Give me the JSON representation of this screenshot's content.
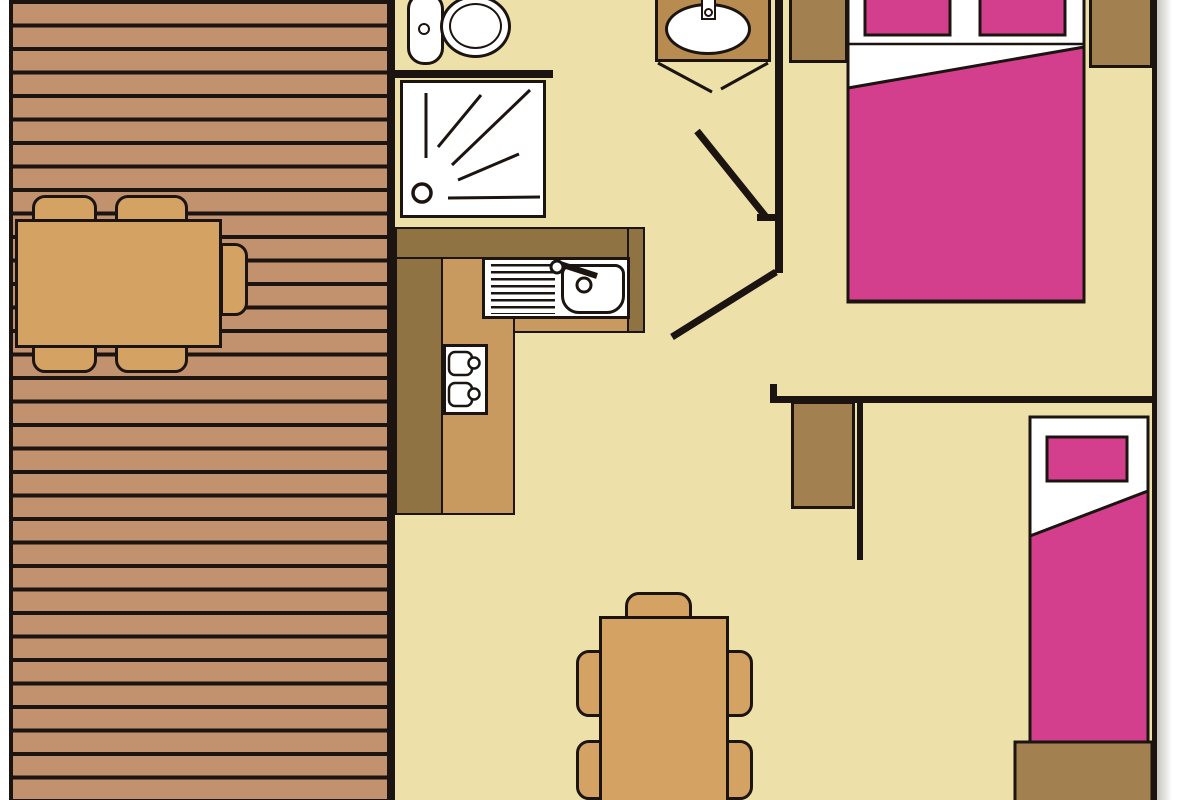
{
  "title": "chalet-floor-plan",
  "colors": {
    "outside": "#ffffff",
    "floor": "#ede0a8",
    "line": "#1b1410",
    "deck_plank": "#c2916e",
    "wood_furniture": "#d4a263",
    "kitchen_dark": "#8f7342",
    "kitchen_light": "#c89a5f",
    "cabinet_brown": "#a2804f",
    "vanity_brown": "#b88b50",
    "textile_pink": "#d43f8d",
    "fixture_white": "#ffffff",
    "shadow": "rgba(90,85,70,0.35)"
  },
  "rooms": [
    {
      "name": "terrace-deck",
      "furniture": [
        "outdoor-table",
        "outdoor-chair x5",
        "plank-decking"
      ]
    },
    {
      "name": "bathroom",
      "furniture": [
        "toilet",
        "shower-tray",
        "washbasin-vanity",
        "door-swing"
      ]
    },
    {
      "name": "kitchen",
      "furniture": [
        "l-shaped-counter",
        "sink-with-drainboard",
        "two-burner-hob"
      ]
    },
    {
      "name": "bedroom-double",
      "furniture": [
        "double-bed",
        "pillow x2",
        "bedside-cabinet x2",
        "door-swing"
      ]
    },
    {
      "name": "hallway",
      "furniture": [
        "wardrobe"
      ]
    },
    {
      "name": "bedroom-single",
      "furniture": [
        "single-bed",
        "pillow",
        "foot-chest"
      ]
    },
    {
      "name": "living-dining",
      "furniture": [
        "dining-table",
        "dining-chair x5"
      ]
    }
  ]
}
